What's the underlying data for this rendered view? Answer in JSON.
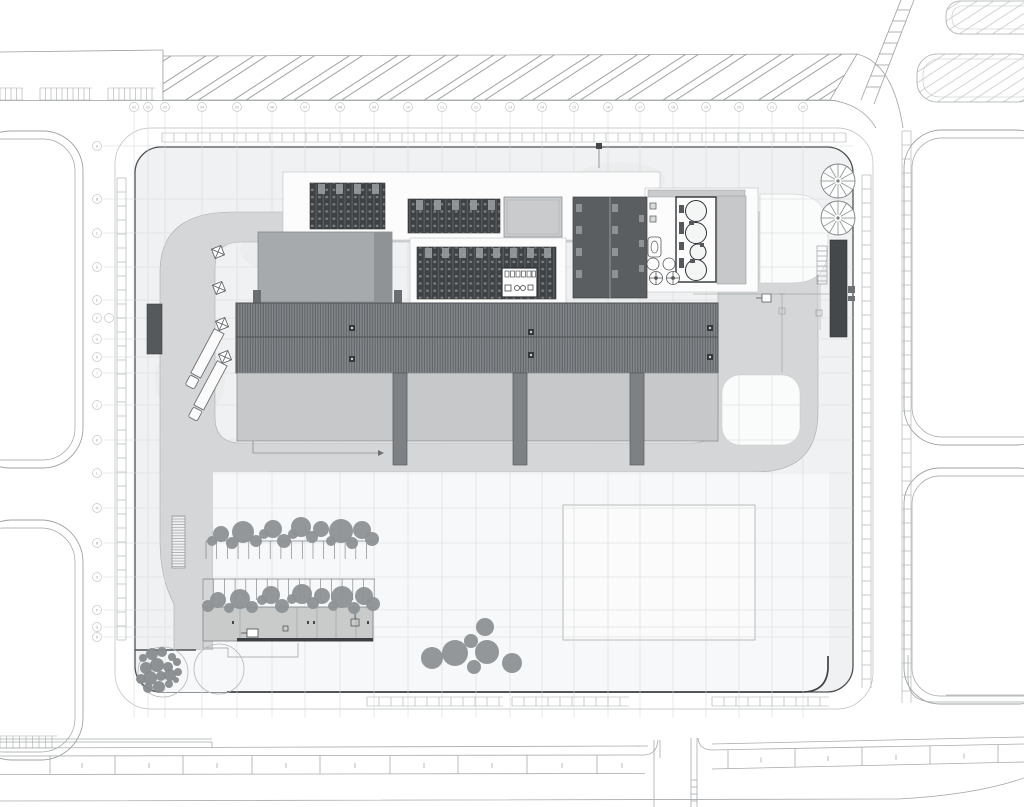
{
  "drawing": {
    "kind": "architectural-site-plan",
    "palette": {
      "site_fill": "#f0f1f2",
      "inner_pad": "#f7f8f9",
      "road_fill": "#d4d6d7",
      "rib_roof": "#83878a",
      "solar_dark": "#3e4244",
      "building_gray": "#a6aaac",
      "bay_gray": "#c6c8c9",
      "dark_block": "#5a5e61",
      "tree_gray": "#8d9193",
      "line_dark": "#4d5153",
      "faint_line": "#d6d9da",
      "walk_line": "#a7abad"
    },
    "grid": {
      "columns": {
        "bubble_y": 107,
        "x": [
          134,
          148,
          165,
          202,
          237,
          272,
          305,
          340,
          374,
          408,
          442,
          476,
          510,
          542,
          574,
          608,
          640,
          673,
          706,
          739,
          772,
          803
        ],
        "labels": [
          "01",
          "02",
          "03",
          "04",
          "05",
          "06",
          "07",
          "08",
          "09",
          "10",
          "11",
          "12",
          "13",
          "14",
          "15",
          "16",
          "17",
          "18",
          "19",
          "20",
          "21",
          "22"
        ],
        "line_y1": 112,
        "line_y2": 718
      },
      "rows": {
        "bubble_x": 97,
        "y": [
          146,
          199,
          233,
          267,
          300,
          318,
          339,
          357,
          373,
          405,
          440,
          473,
          508,
          543,
          577,
          610,
          627,
          637
        ],
        "labels": [
          "A",
          "B",
          "C",
          "D",
          "E",
          "F",
          "G",
          "H",
          "I",
          "J",
          "K",
          "L",
          "M",
          "N",
          "O",
          "P",
          "Q",
          "R"
        ],
        "line_x1": 103,
        "line_x2": 853,
        "double_bubble": {
          "x": 109,
          "y": 318
        }
      }
    },
    "walk_bands": [
      {
        "o": "h",
        "x1": 162,
        "x2": 846,
        "y": 133,
        "w": 9,
        "s": 12
      },
      {
        "o": "v",
        "x": 117,
        "y1": 178,
        "y2": 640,
        "w": 9,
        "s": 14
      },
      {
        "o": "v",
        "x": 862,
        "y1": 175,
        "y2": 688,
        "w": 9,
        "s": 14
      },
      {
        "o": "v",
        "x": 902,
        "y1": 131,
        "y2": 703,
        "w": 9,
        "s": 14
      },
      {
        "o": "h",
        "x1": 367,
        "x2": 503,
        "y": 697,
        "w": 9,
        "s": 12
      },
      {
        "o": "h",
        "x1": 512,
        "x2": 629,
        "y": 697,
        "w": 9,
        "s": 12
      },
      {
        "o": "h",
        "x1": 712,
        "x2": 829,
        "y": 697,
        "w": 9,
        "s": 12
      },
      {
        "o": "h",
        "x1": 0,
        "x2": 23,
        "y": 88,
        "w": 12,
        "s": 5.5
      },
      {
        "o": "h",
        "x1": 40,
        "x2": 92,
        "y": 88,
        "w": 12,
        "s": 5.5
      },
      {
        "o": "h",
        "x1": 108,
        "x2": 155,
        "y": 88,
        "w": 12,
        "s": 5.5
      },
      {
        "o": "h",
        "x1": 0,
        "x2": 57,
        "y": 736,
        "w": 12,
        "s": 6.5
      }
    ],
    "parking_rows": [
      {
        "x1": 206,
        "x2": 377,
        "y": 541,
        "len": 18,
        "s": 10.7
      },
      {
        "x1": 203,
        "x2": 375,
        "y": 579,
        "len": 21,
        "s": 10.7
      }
    ],
    "trees": {
      "row1": [
        [
          212,
          541,
          5
        ],
        [
          221,
          534,
          8
        ],
        [
          232,
          543,
          6
        ],
        [
          243,
          532,
          11
        ],
        [
          256,
          541,
          6
        ],
        [
          264,
          534,
          5
        ],
        [
          273,
          529,
          9
        ],
        [
          284,
          541,
          7
        ],
        [
          293,
          534,
          5
        ],
        [
          301,
          527,
          10
        ],
        [
          312,
          537,
          6
        ],
        [
          321,
          529,
          8
        ],
        [
          331,
          541,
          5
        ],
        [
          341,
          531,
          12
        ],
        [
          352,
          543,
          6
        ],
        [
          362,
          530,
          9
        ],
        [
          372,
          539,
          7
        ]
      ],
      "row2": [
        [
          208,
          606,
          6
        ],
        [
          218,
          600,
          8
        ],
        [
          229,
          608,
          5
        ],
        [
          240,
          599,
          10
        ],
        [
          252,
          607,
          6
        ],
        [
          262,
          600,
          5
        ],
        [
          271,
          595,
          9
        ],
        [
          282,
          606,
          7
        ],
        [
          292,
          599,
          5
        ],
        [
          302,
          594,
          10
        ],
        [
          313,
          603,
          6
        ],
        [
          322,
          596,
          8
        ],
        [
          333,
          606,
          5
        ],
        [
          342,
          597,
          11
        ],
        [
          354,
          608,
          6
        ],
        [
          364,
          596,
          9
        ],
        [
          373,
          604,
          7
        ]
      ],
      "shrubs": [
        [
          143,
          658,
          4
        ],
        [
          152,
          654,
          6
        ],
        [
          162,
          652,
          5
        ],
        [
          172,
          657,
          4
        ],
        [
          146,
          668,
          6
        ],
        [
          157,
          665,
          7
        ],
        [
          168,
          667,
          5
        ],
        [
          177,
          662,
          4
        ],
        [
          141,
          679,
          5
        ],
        [
          150,
          678,
          7
        ],
        [
          161,
          676,
          5
        ],
        [
          170,
          675,
          6
        ],
        [
          178,
          672,
          4
        ],
        [
          148,
          688,
          5
        ],
        [
          159,
          687,
          6
        ],
        [
          169,
          684,
          4
        ],
        [
          176,
          680,
          3
        ]
      ],
      "cluster": [
        [
          485,
          627,
          9
        ],
        [
          471,
          641,
          7
        ],
        [
          455,
          653,
          13
        ],
        [
          432,
          658,
          11
        ],
        [
          487,
          652,
          12
        ],
        [
          474,
          667,
          7
        ],
        [
          512,
          663,
          10
        ]
      ],
      "spoked": [
        [
          838,
          181,
          17
        ],
        [
          838,
          218,
          17
        ]
      ]
    }
  }
}
